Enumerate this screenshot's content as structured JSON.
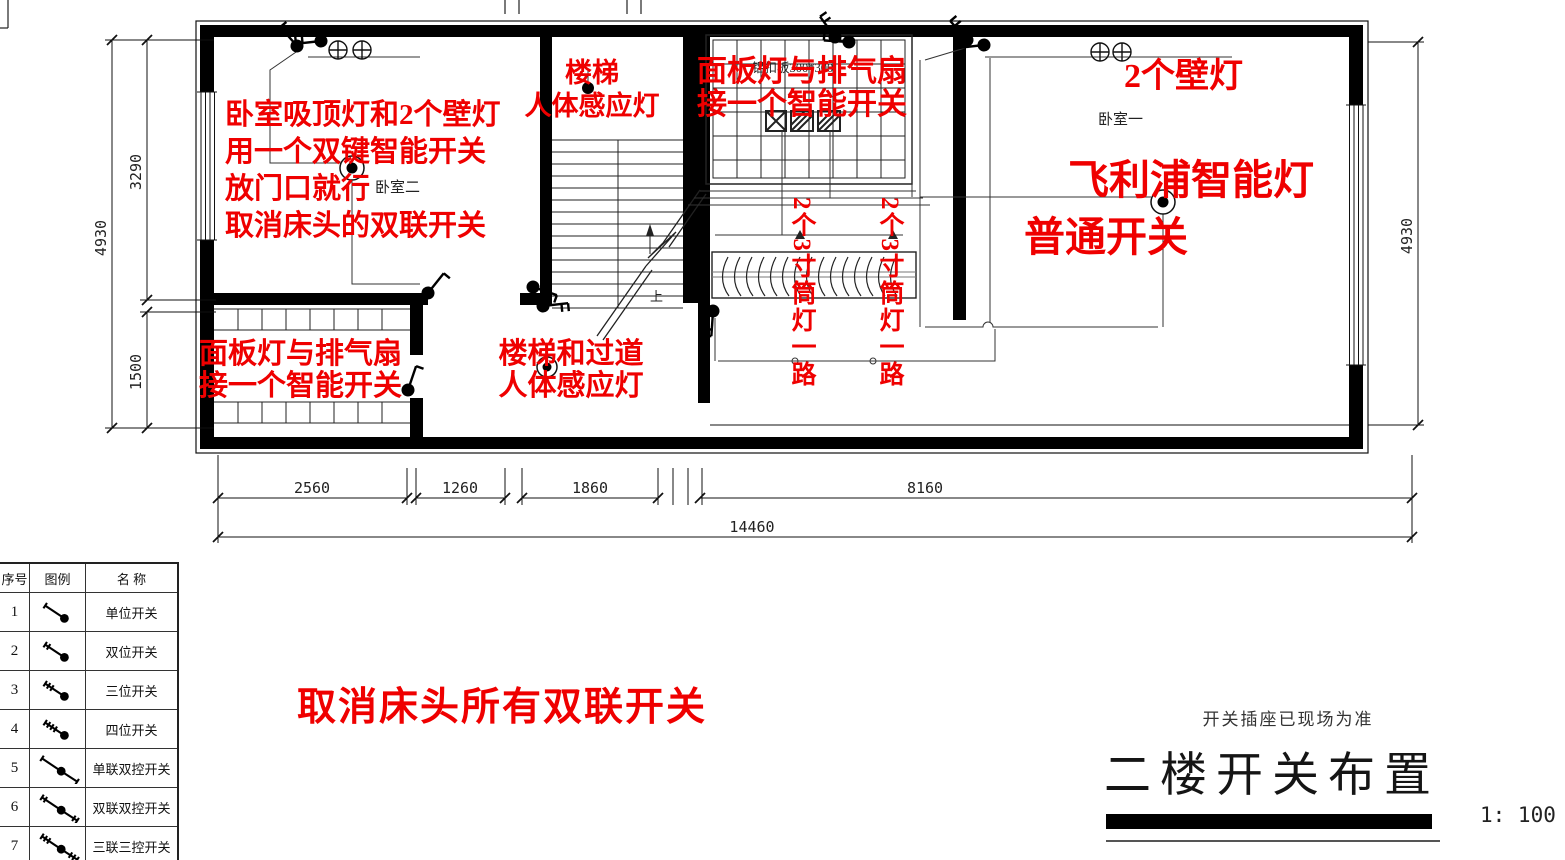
{
  "colors": {
    "annotation": "#ef0000",
    "line": "#111111",
    "muted": "#8c8c8c"
  },
  "annotations": {
    "bedroom2": {
      "lines": [
        "卧室吸顶灯和2个壁灯",
        "用一个双键智能开关",
        "放门口就行",
        "取消床头的双联开关"
      ]
    },
    "stair_top": {
      "lines": [
        "楼梯",
        "人体感应灯"
      ]
    },
    "panel_top": {
      "lines": [
        "面板灯与排气扇",
        "接一个智能开关"
      ]
    },
    "wall_lamps": "2个壁灯",
    "philips": {
      "lines": [
        "飞利浦智能灯",
        "普通开关"
      ]
    },
    "downlight_left": "2个3寸筒灯一路",
    "downlight_right": "2个3寸筒灯一路",
    "bathroom": {
      "lines": [
        "面板灯与排气扇",
        "接一个智能开关"
      ]
    },
    "corridor": {
      "lines": [
        "楼梯和过道",
        "人体感应灯"
      ]
    },
    "cancel_all": "取消床头所有双联开关"
  },
  "plan_labels": {
    "bedroom2": "卧室二",
    "bedroom1": "卧室一",
    "ceiling": "铝扣板300*300",
    "up": "上"
  },
  "dimensions": {
    "left_total": "4930",
    "left_top": "3290",
    "left_bottom": "1500",
    "right_total": "4930",
    "bottom_segments": [
      "2560",
      "1260",
      "1860",
      "8160"
    ],
    "bottom_total": "14460"
  },
  "legend": {
    "headers": [
      "序号",
      "图例",
      "名 称"
    ],
    "rows": [
      {
        "no": "1",
        "name": "单位开关"
      },
      {
        "no": "2",
        "name": "双位开关"
      },
      {
        "no": "3",
        "name": "三位开关"
      },
      {
        "no": "4",
        "name": "四位开关"
      },
      {
        "no": "5",
        "name": "单联双控开关"
      },
      {
        "no": "6",
        "name": "双联双控开关"
      },
      {
        "no": "7",
        "name": "三联三控开关"
      }
    ]
  },
  "title_block": {
    "note": "开关插座已现场为准",
    "title": "二楼开关布置",
    "scale": "1: 100"
  }
}
